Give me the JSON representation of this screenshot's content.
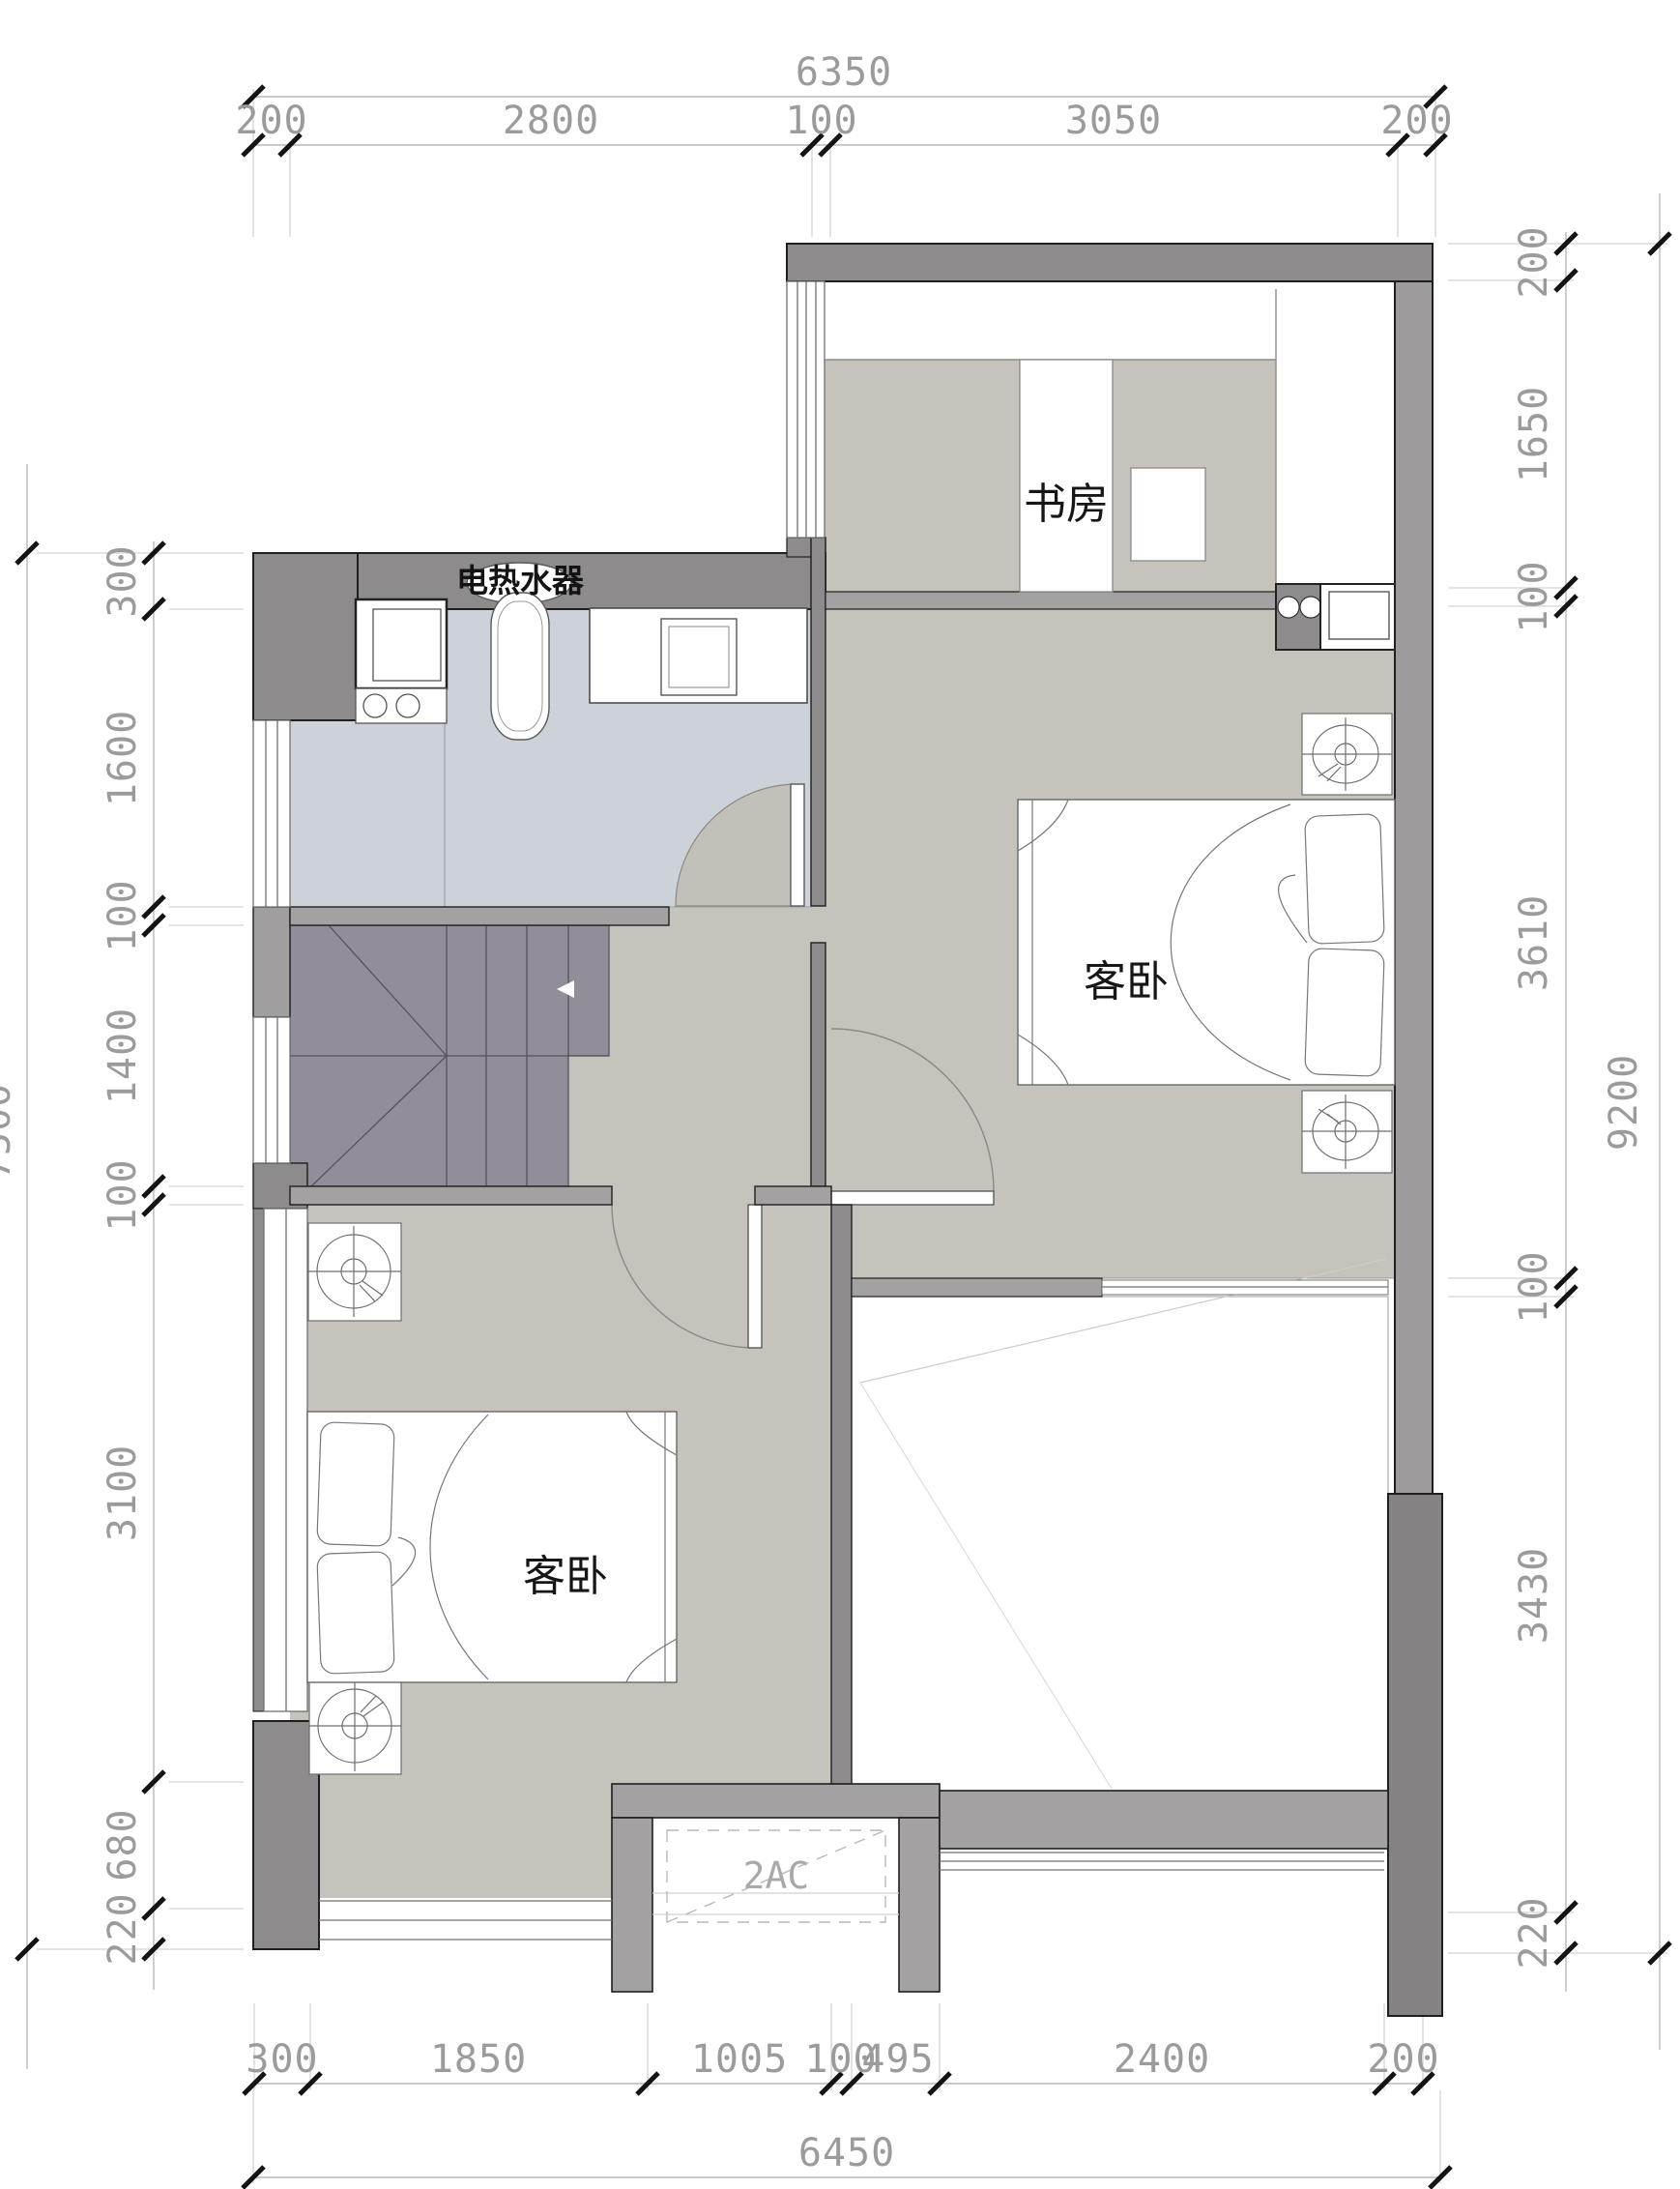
{
  "plan": {
    "rooms": {
      "study_label": "书房",
      "bedroom_right_label": "客卧",
      "bedroom_left_label": "客卧",
      "water_heater_label": "电热水器",
      "ac_platform_label": "2AC"
    },
    "dims": {
      "top_overall": "6350",
      "top_seg": [
        "200",
        "2800",
        "100",
        "3050",
        "200"
      ],
      "bottom_seg": [
        "300",
        "1850",
        "1005",
        "100",
        "495",
        "2400",
        "200"
      ],
      "bottom_overall": "6450",
      "left_overall": "7500",
      "left_seg": [
        "300",
        "1600",
        "100",
        "1400",
        "100",
        "3100",
        "680",
        "220"
      ],
      "right_overall": "9200",
      "right_seg": [
        "200",
        "1650",
        "100",
        "3610",
        "100",
        "3430",
        "220"
      ]
    },
    "colors": {
      "wall_dark": "#8d8b8b",
      "wall_medium": "#a3a1a1",
      "wall_light": "#9c9a9a",
      "floor_warm": "#c6c3bc",
      "floor_bath": "#ccd2d7",
      "stairs": "#918e99",
      "dim_text": "#9b9b9b"
    }
  }
}
